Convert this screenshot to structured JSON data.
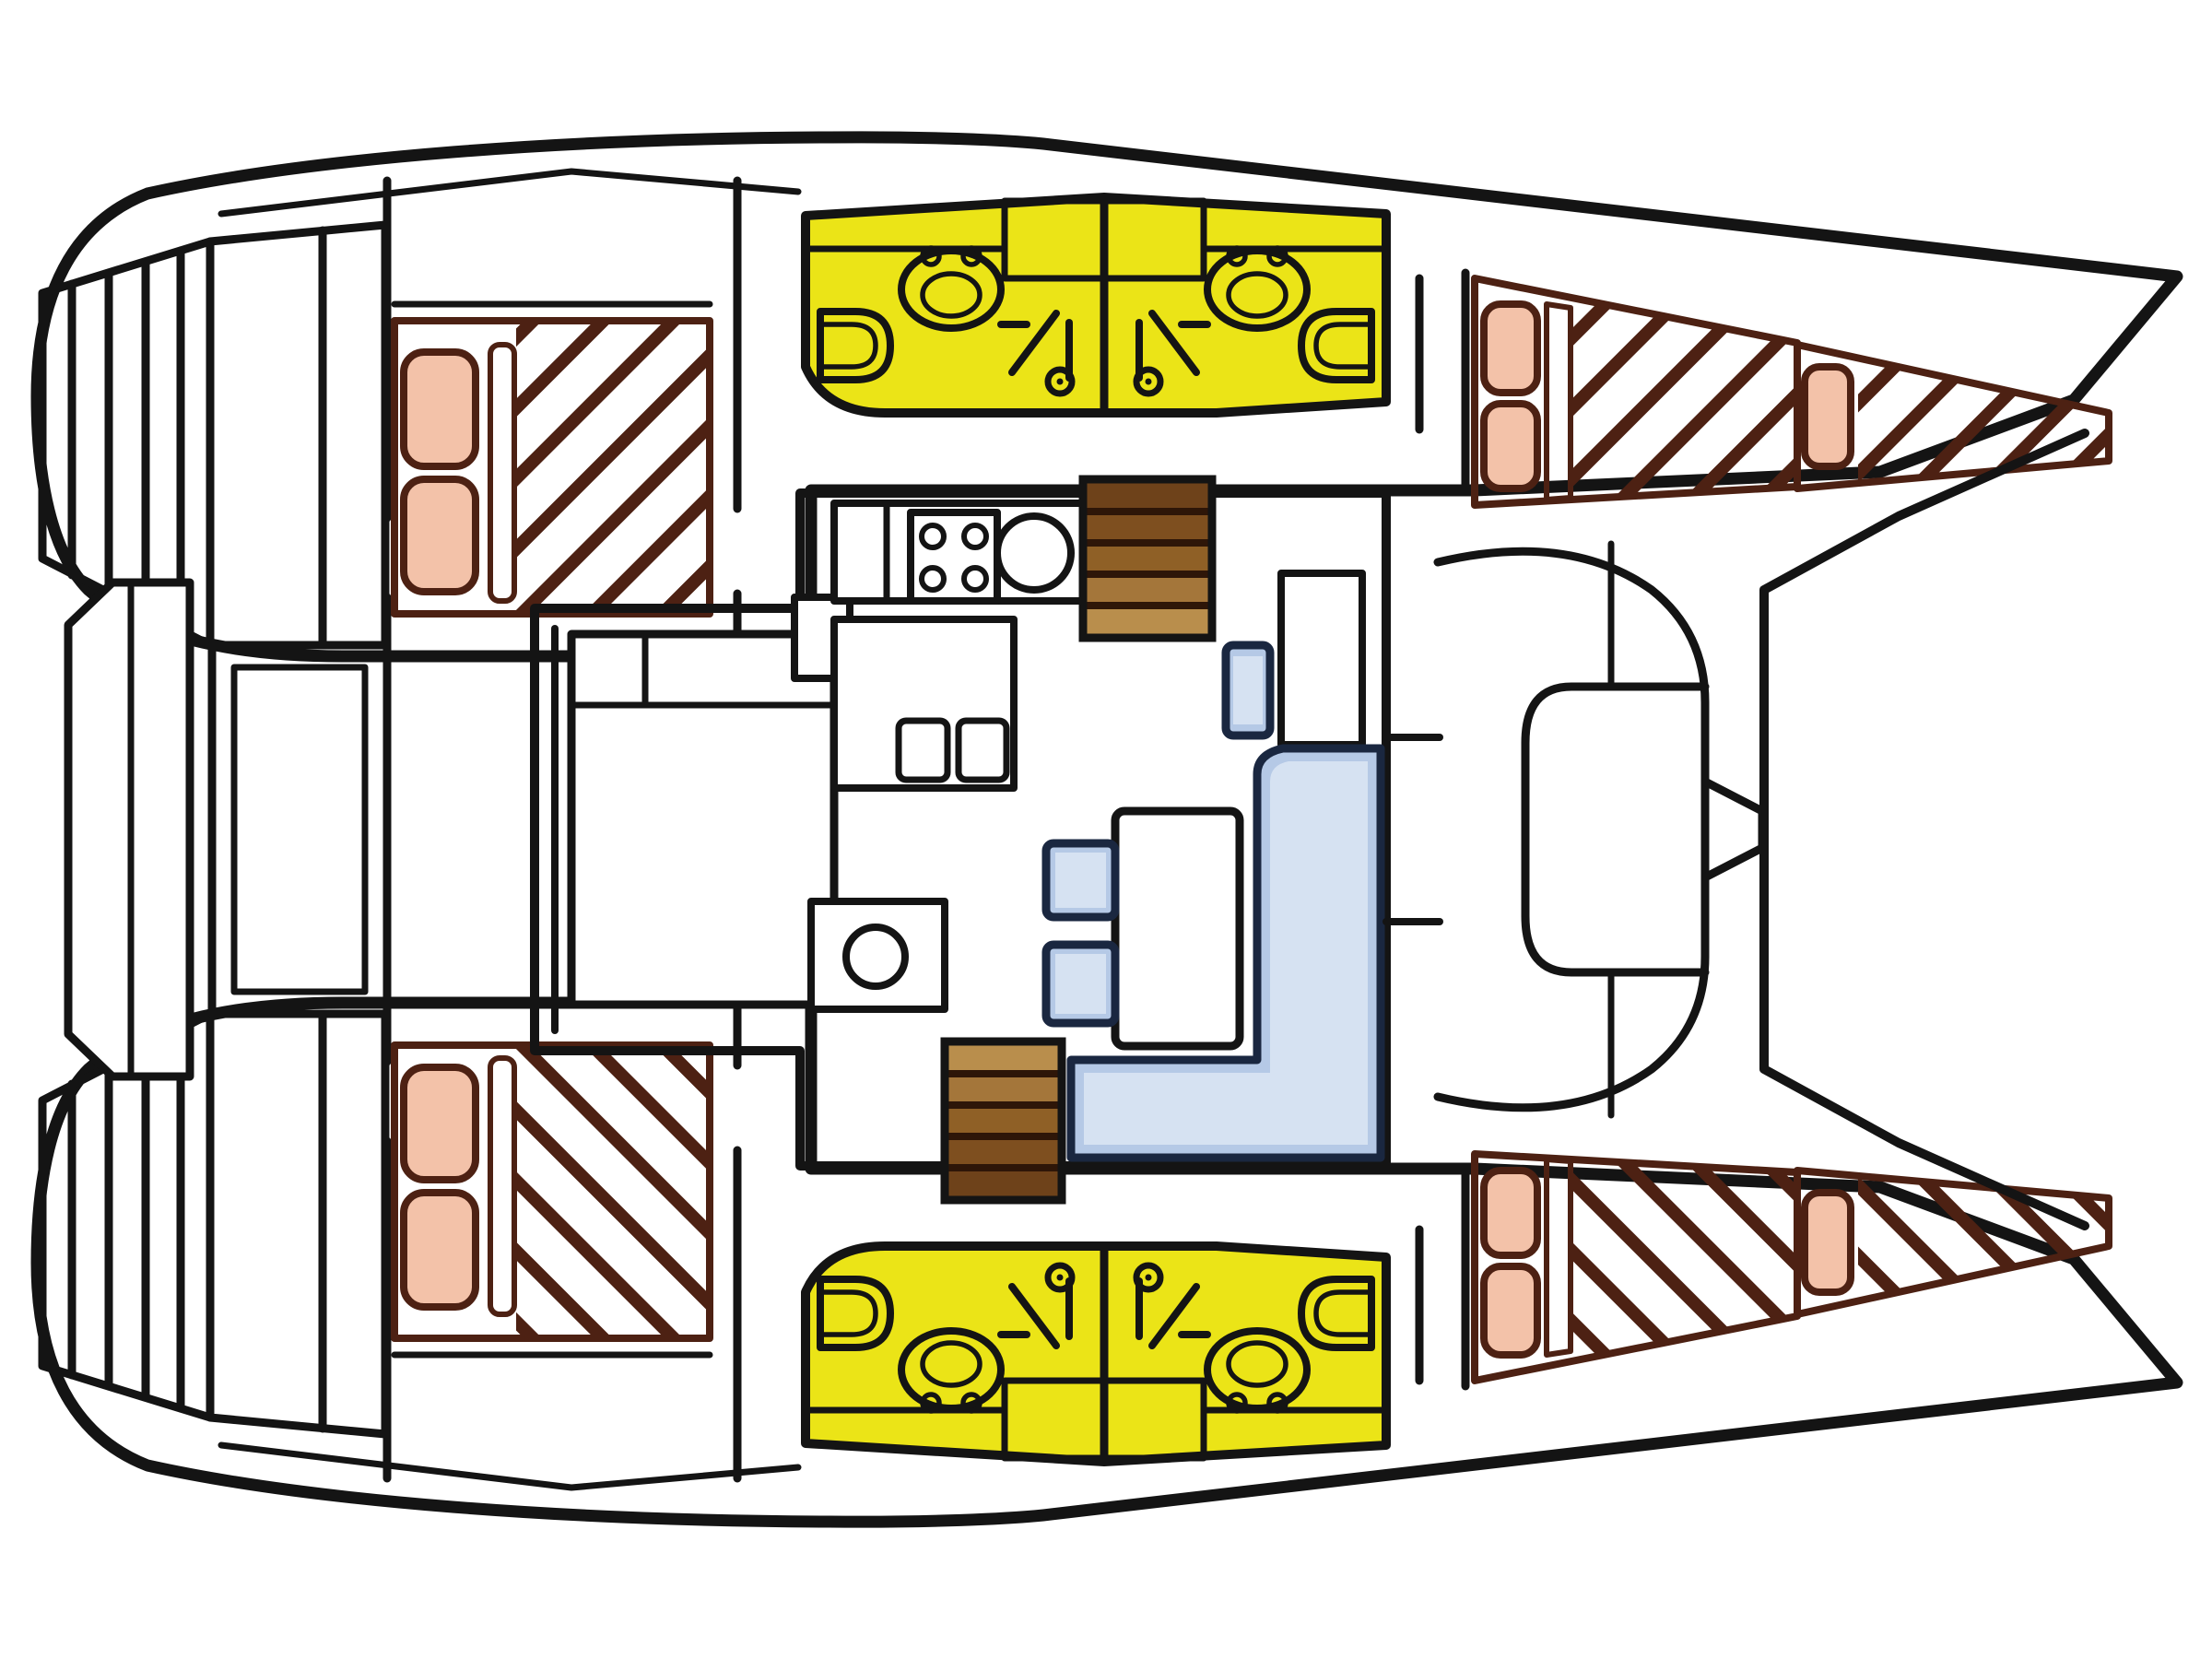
{
  "diagram": {
    "title": "Catamaran interior layout — top-down floor plan",
    "type": "boat-floorplan",
    "orientation": {
      "bow": "right",
      "stern": "left",
      "hulls": 2
    },
    "colors": {
      "line": "#141414",
      "hull-fill": "#ffffff",
      "bed-fill": "#f6cab3",
      "bed-pillow": "#f3c2a9",
      "hatch-line": "#4d2113",
      "bathroom-fill": "#ebe417",
      "sofa-fill": "#b5c9e6",
      "sofa-light": "#d6e2f2",
      "sofa-outline": "#1a2740",
      "step-1": "#6e421a",
      "step-2": "#7e4f1f",
      "step-3": "#8f6026",
      "step-4": "#a4763a",
      "step-5": "#b98e4c",
      "steps-line": "#2e1608"
    },
    "rooms": [
      {
        "id": "hull-top",
        "name": "Hull (upper) — cabins and bathroom"
      },
      {
        "id": "hull-bottom",
        "name": "Hull (lower) — cabins and bathroom"
      },
      {
        "id": "salon",
        "name": "Salon / bridgedeck saloon"
      },
      {
        "id": "aft-cockpit",
        "name": "Aft cockpit with bench"
      },
      {
        "id": "fore-cockpit",
        "name": "Forward cockpit with C-shaped bench"
      },
      {
        "id": "aft-cabin",
        "name": "Aft cabin with double berth"
      },
      {
        "id": "fwd-cabin",
        "name": "Forward cabin with double berth"
      },
      {
        "id": "bow-berth",
        "name": "Bow berth"
      },
      {
        "id": "bathroom",
        "name": "Twin bathrooms (toilet, basin, shower)"
      }
    ],
    "fixtures": [
      {
        "id": "transom-steps",
        "name": "Transom swim steps"
      },
      {
        "id": "swim-platform",
        "name": "Aft platform between hulls"
      },
      {
        "id": "galley-stove",
        "name": "Galley stove with 4 burners"
      },
      {
        "id": "galley-sink",
        "name": "Round galley sink"
      },
      {
        "id": "galley-twin-sink",
        "name": "Twin square sinks"
      },
      {
        "id": "galley-island",
        "name": "Galley island counter"
      },
      {
        "id": "companionway-a",
        "name": "Companionway steps to upper hull"
      },
      {
        "id": "companionway-b",
        "name": "Companionway steps to lower hull"
      },
      {
        "id": "salon-table",
        "name": "Salon table"
      },
      {
        "id": "settee",
        "name": "L-shaped settee"
      },
      {
        "id": "seats",
        "name": "Salon seats"
      },
      {
        "id": "nav-table",
        "name": "Chart table"
      },
      {
        "id": "toilet",
        "name": "Marine toilet"
      },
      {
        "id": "basin",
        "name": "Wash basin"
      },
      {
        "id": "shower",
        "name": "Shower"
      }
    ]
  }
}
